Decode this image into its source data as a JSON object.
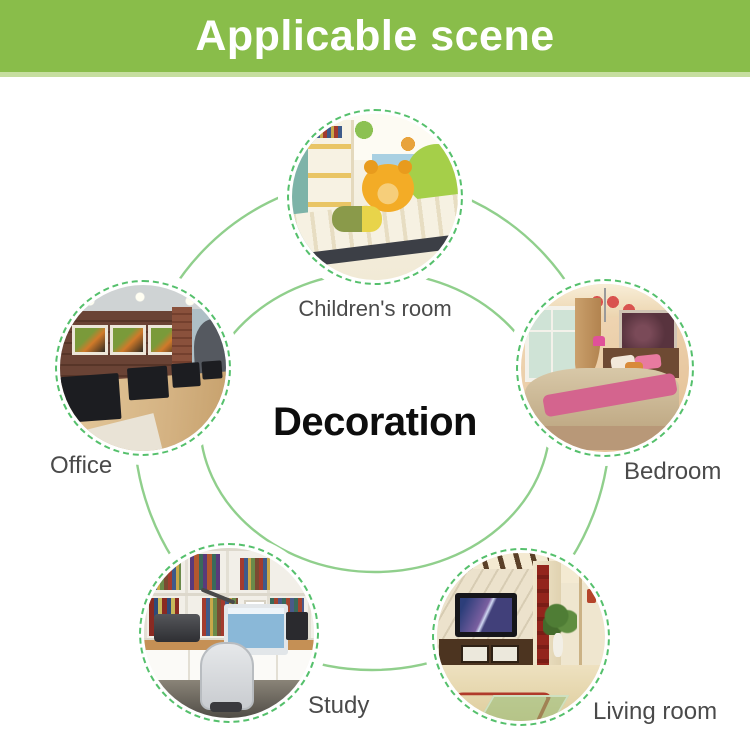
{
  "header": {
    "title": "Applicable scene",
    "bg_color": "#89bd4a",
    "bottom_strip_color": "#c6de9f",
    "text_color": "#ffffff"
  },
  "center": {
    "label": "Decoration"
  },
  "scenes": [
    {
      "id": "children",
      "label": "Children's room",
      "position": "top"
    },
    {
      "id": "office",
      "label": "Office",
      "position": "left"
    },
    {
      "id": "bedroom",
      "label": "Bedroom",
      "position": "right"
    },
    {
      "id": "study",
      "label": "Study",
      "position": "bottom-left"
    },
    {
      "id": "living",
      "label": "Living room",
      "position": "bottom-right"
    }
  ],
  "colors": {
    "ring_solid_line": "#90cf8c",
    "ring_dashed_border": "#55c06c",
    "label_text": "#4a4a4a",
    "center_text": "#0d0d0d"
  }
}
